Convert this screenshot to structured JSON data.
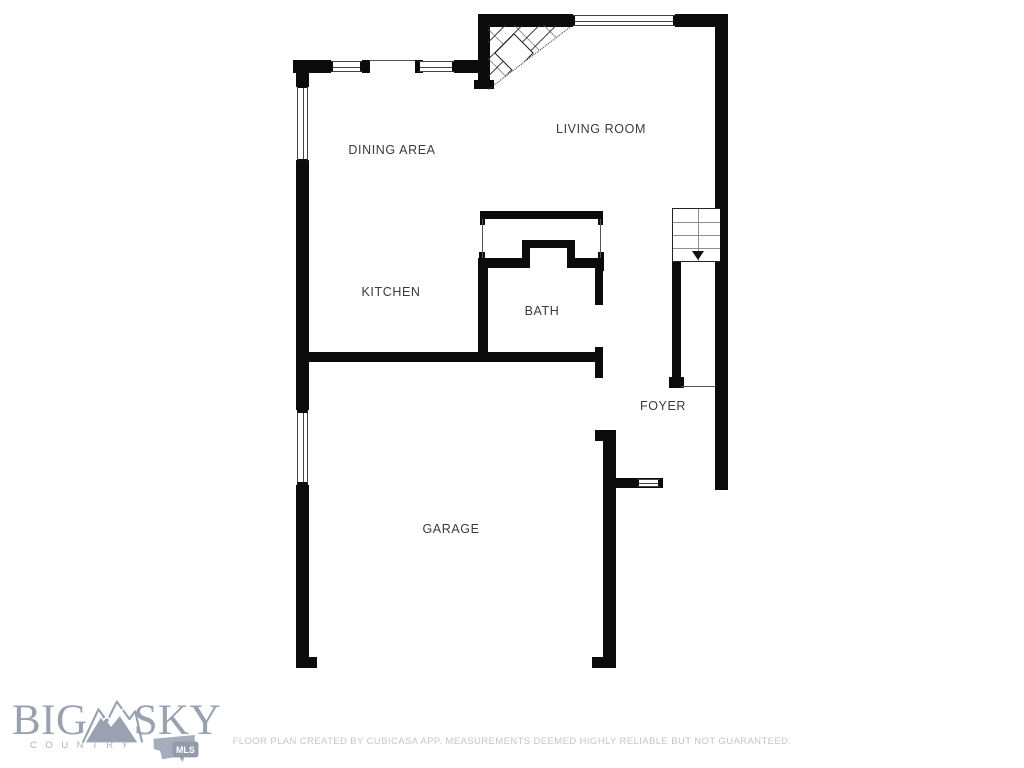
{
  "plan": {
    "wall_color": "#0b0b0b",
    "label_color": "#3b3b3b",
    "rooms": [
      {
        "name": "DINING AREA",
        "x": 392,
        "y": 150
      },
      {
        "name": "LIVING ROOM",
        "x": 601,
        "y": 129
      },
      {
        "name": "KITCHEN",
        "x": 391,
        "y": 292
      },
      {
        "name": "BATH",
        "x": 542,
        "y": 311
      },
      {
        "name": "FOYER",
        "x": 663,
        "y": 406
      },
      {
        "name": "GARAGE",
        "x": 451,
        "y": 529
      }
    ],
    "walls": [
      [
        478,
        14,
        95,
        13
      ],
      [
        675,
        14,
        53,
        13
      ],
      [
        715,
        14,
        13,
        476
      ],
      [
        478,
        14,
        12,
        73
      ],
      [
        474,
        80,
        20,
        9
      ],
      [
        293,
        60,
        38,
        13
      ],
      [
        362,
        60,
        8,
        13
      ],
      [
        415,
        60,
        8,
        13
      ],
      [
        454,
        60,
        26,
        13
      ],
      [
        296,
        60,
        13,
        27
      ],
      [
        296,
        160,
        13,
        192
      ],
      [
        296,
        352,
        307,
        10
      ],
      [
        296,
        362,
        13,
        48
      ],
      [
        296,
        485,
        13,
        172
      ],
      [
        296,
        657,
        21,
        11
      ],
      [
        603,
        440,
        13,
        217
      ],
      [
        592,
        657,
        24,
        11
      ],
      [
        595,
        430,
        21,
        11
      ],
      [
        616,
        478,
        47,
        10
      ],
      [
        480,
        211,
        123,
        8
      ],
      [
        480,
        219,
        5,
        6
      ],
      [
        598,
        219,
        5,
        6
      ],
      [
        480,
        258,
        47,
        10
      ],
      [
        522,
        240,
        8,
        28
      ],
      [
        522,
        240,
        53,
        8
      ],
      [
        567,
        240,
        8,
        28
      ],
      [
        567,
        258,
        36,
        10
      ],
      [
        479,
        252,
        6,
        19
      ],
      [
        598,
        252,
        6,
        19
      ],
      [
        478,
        258,
        10,
        104
      ],
      [
        595,
        258,
        8,
        47
      ],
      [
        595,
        347,
        8,
        31
      ],
      [
        672,
        262,
        9,
        121
      ],
      [
        669,
        377,
        15,
        11
      ]
    ],
    "thin_lines": [
      [
        369,
        60,
        46,
        1
      ],
      [
        482,
        219,
        1,
        39
      ],
      [
        600,
        219,
        1,
        39
      ],
      [
        681,
        386,
        34,
        1
      ],
      [
        677,
        209,
        1,
        52
      ]
    ],
    "windows": [
      {
        "x": 330,
        "y": 61,
        "w": 33,
        "h": 11,
        "dir": "h"
      },
      {
        "x": 417,
        "y": 61,
        "w": 38,
        "h": 11,
        "dir": "h"
      },
      {
        "x": 572,
        "y": 15,
        "w": 104,
        "h": 11,
        "dir": "h"
      },
      {
        "x": 297,
        "y": 85,
        "w": 11,
        "h": 77,
        "dir": "v"
      },
      {
        "x": 297,
        "y": 410,
        "w": 11,
        "h": 75,
        "dir": "v"
      },
      {
        "x": 636,
        "y": 479,
        "w": 25,
        "h": 8,
        "dir": "h"
      }
    ],
    "stairs": {
      "x": 672,
      "y": 208,
      "w": 48,
      "h": 54,
      "tread_rows": 4,
      "center_line_pct": 53,
      "arrow_direction": "down"
    },
    "fireplace": {
      "x": 488,
      "y": 25,
      "w": 84,
      "h": 64,
      "diamond_size": 26,
      "diamond_left": 12,
      "diamond_top": 14
    }
  },
  "branding": {
    "big": "BIG",
    "sky": "SKY",
    "country": "COUNTRY",
    "mls": "MLS",
    "logo_color": "#9aa2b2"
  },
  "footer": {
    "disclaimer": "FLOOR PLAN CREATED BY CUBICASA APP. MEASUREMENTS DEEMED HIGHLY RELIABLE BUT NOT GUARANTEED."
  }
}
